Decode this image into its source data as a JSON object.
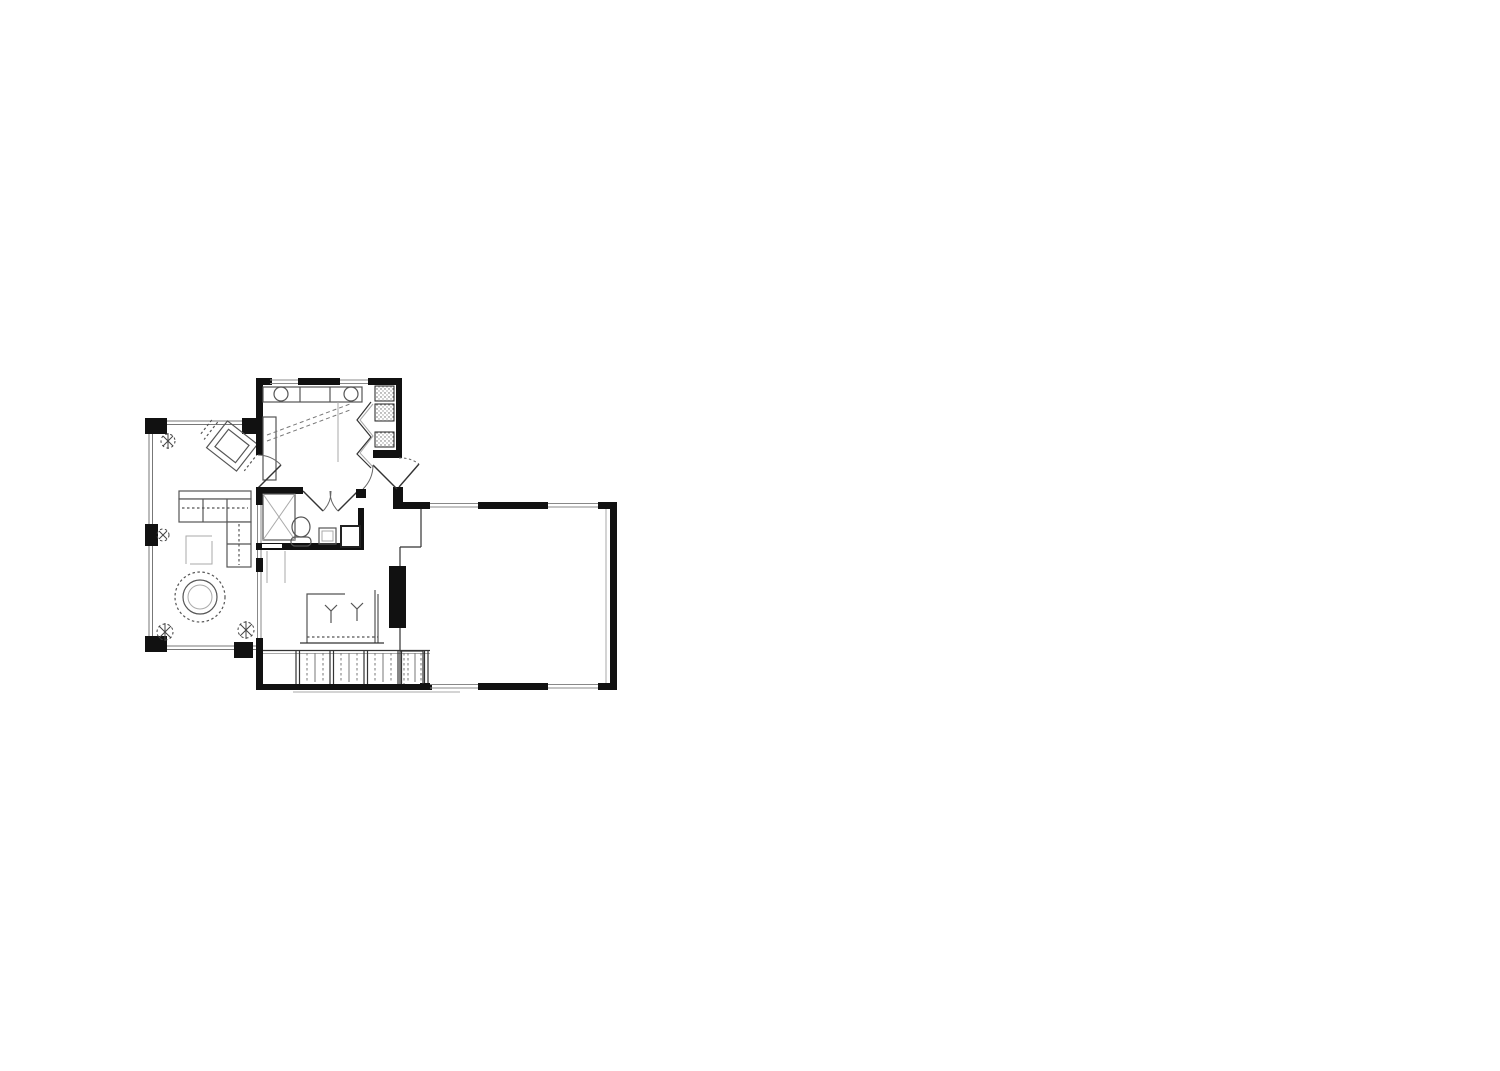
{
  "meta": {
    "document_type": "architectural floor plan drawing",
    "visible_text": "",
    "background_color": "#ffffff"
  },
  "palette": {
    "wall": "#111111",
    "structure_line": "#333333",
    "window_line": "#888888",
    "furniture_line": "#555555",
    "light_line": "#aaaaaa"
  },
  "plan": {
    "rooms": [
      {
        "id": "deck",
        "label": "screened deck / porch"
      },
      {
        "id": "kitchen",
        "label": "kitchen"
      },
      {
        "id": "pantry",
        "label": "corner pantry with shelves"
      },
      {
        "id": "bathroom",
        "label": "bathroom"
      },
      {
        "id": "hallway",
        "label": "rear hallway"
      },
      {
        "id": "living-area",
        "label": "living / bar area"
      },
      {
        "id": "stairs",
        "label": "entry steps / stair run"
      },
      {
        "id": "garage",
        "label": "large garage room"
      }
    ],
    "furniture": [
      "corner posts",
      "planters",
      "rotated hot-tub square",
      "sectional sofa",
      "coffee table",
      "round dining table with chairs",
      "kitchen counter with two basins",
      "pantry shelving",
      "bi-fold pantry doors",
      "closet with cross brace",
      "toilet",
      "vanity sink",
      "shower unit",
      "bar counter",
      "two bar stools",
      "fireplace mass",
      "garage closet with sliding door"
    ]
  }
}
